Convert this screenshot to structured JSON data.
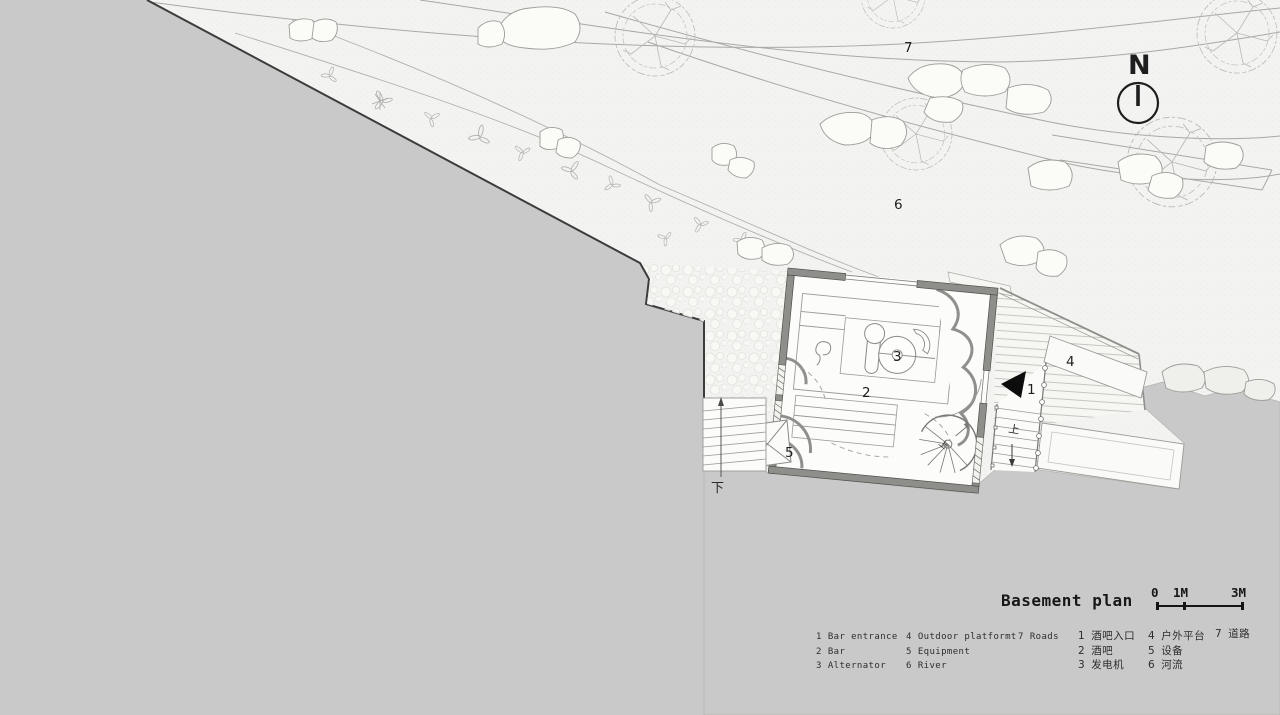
{
  "meta": {
    "drawing_type": "architectural basement site plan"
  },
  "colors": {
    "terrain_gray": "#c9c9c9",
    "paper": "#f3f3f1",
    "wall_gray": "#8e8e8b",
    "boundary_dark": "#3c3c3c",
    "drawing_line": "#9a9a97",
    "ink": "#1f1f1f"
  },
  "north": {
    "label": "N"
  },
  "plan_labels": {
    "bar_entrance": "1",
    "bar": "2",
    "alternator": "3",
    "outdoor_platform": "4",
    "equipment": "5",
    "river": "6",
    "roads": "7"
  },
  "direction_labels": {
    "down": "下",
    "up_stairs": "上",
    "up_spiral": "上"
  },
  "title_block": {
    "title": "Basement plan",
    "scale_ticks": [
      "0",
      "1M",
      "3M"
    ]
  },
  "legend": {
    "en": [
      {
        "num": "1",
        "label": "Bar entrance"
      },
      {
        "num": "2",
        "label": "Bar"
      },
      {
        "num": "3",
        "label": "Alternator"
      },
      {
        "num": "4",
        "label": "Outdoor platformt"
      },
      {
        "num": "5",
        "label": "Equipment"
      },
      {
        "num": "6",
        "label": "River"
      },
      {
        "num": "7",
        "label": "Roads"
      }
    ],
    "zh": [
      {
        "num": "1",
        "label": "酒吧入口"
      },
      {
        "num": "2",
        "label": "酒吧"
      },
      {
        "num": "3",
        "label": "发电机"
      },
      {
        "num": "4",
        "label": "户外平台"
      },
      {
        "num": "5",
        "label": "设备"
      },
      {
        "num": "6",
        "label": "河流"
      },
      {
        "num": "7",
        "label": "道路"
      }
    ]
  }
}
